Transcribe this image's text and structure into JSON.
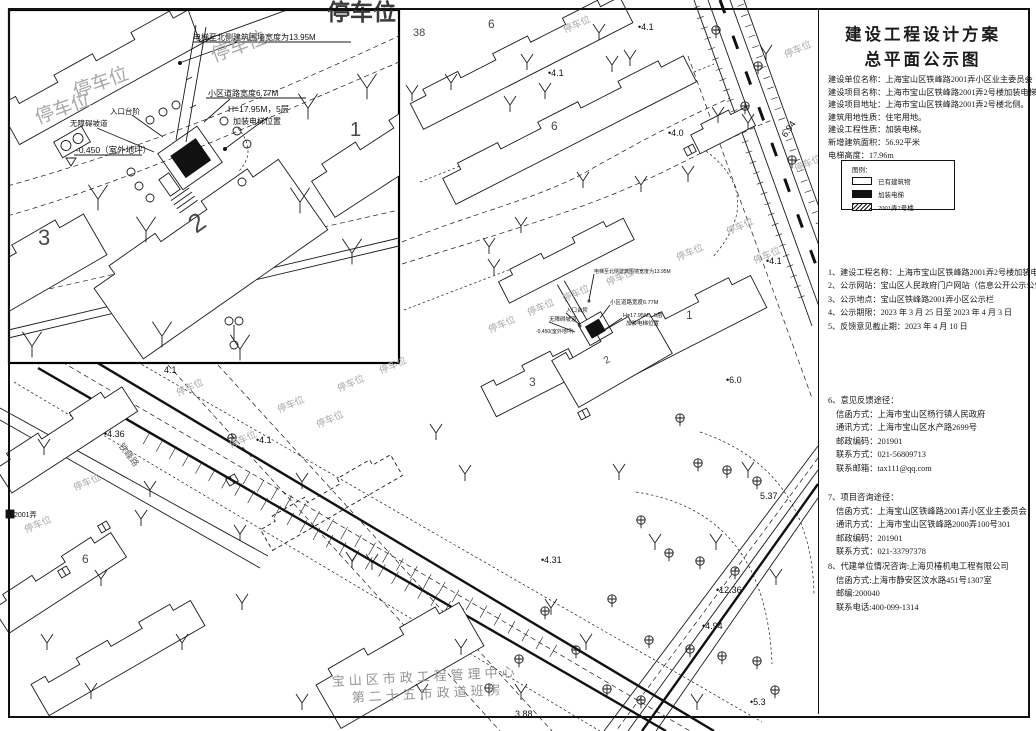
{
  "panel": {
    "title": [
      "建设工程设计方案",
      "总平面公示图"
    ],
    "info": [
      "建设单位名称：上海宝山区铁峰路2001弄小区业主委员会",
      "建设项目名称：上海市宝山区铁峰路2001弄2号楼加装电梯项目。",
      "建设项目地址：上海市宝山区铁峰路2001弄2号楼北侧。",
      "建筑用地性质：住宅用地。",
      "建设工程性质：加装电梯。",
      "新增建筑面积：56.92平米",
      "电梯高度：17.96m"
    ],
    "legend": {
      "title": "图例：",
      "items": [
        {
          "key": "existing",
          "label": "已有建筑物"
        },
        {
          "key": "elevator",
          "label": "加装电梯"
        },
        {
          "key": "hatch",
          "label": "2001弄2号楼"
        }
      ]
    },
    "notices": [
      "1、建设工程名称：上海市宝山区铁峰路2001弄2号楼加装电梯项目",
      "2、公示网站：宝山区人民政府门户网站（信息公开公示公告栏目）",
      "3、公示地点：宝山区铁峰路2001弄小区公示栏",
      "4、公示期限：2023 年 3 月 25 日至 2023 年 4 月 3 日",
      "5、反馈意见截止期：2023 年 4 月 10 日"
    ],
    "sections": [
      {
        "title": "6、意见反馈途径：",
        "lines": [
          "信函方式：上海市宝山区杨行镇人民政府",
          "通讯方式：上海市宝山区水产路2699号",
          "邮政编码：201901",
          "联系方式：021-56809713",
          "联系邮箱：tax111@qq.com"
        ]
      },
      {
        "title": "7、项目咨询途径：",
        "lines": [
          "信函方式：上海宝山区铁峰路2001弄小区业主委员会",
          "通讯方式：上海市宝山区铁峰路2000弄100号301",
          "邮政编码：201901",
          "联系方式：021-33797378"
        ]
      },
      {
        "title": "8、代建单位情况咨询:上海贝椿机电工程有限公司",
        "lines": [
          "信函方式:上海市静安区汶水路451号1307室",
          "邮编:200040",
          "联系电话:400-099-1314"
        ]
      }
    ]
  },
  "plan": {
    "labels": [
      {
        "t": "停车位",
        "x": 565,
        "y": 33,
        "r": -24,
        "s": 9.5,
        "c": "park"
      },
      {
        "t": "停车位",
        "x": 786,
        "y": 58,
        "r": -24,
        "s": 9.5,
        "c": "park"
      },
      {
        "t": "停车位",
        "x": 796,
        "y": 172,
        "r": -24,
        "s": 9.5,
        "c": "park"
      },
      {
        "t": "停车位",
        "x": 728,
        "y": 235,
        "r": -24,
        "s": 9.5,
        "c": "park"
      },
      {
        "t": "停车位",
        "x": 755,
        "y": 264,
        "r": -24,
        "s": 9.5,
        "c": "park"
      },
      {
        "t": "停车位",
        "x": 678,
        "y": 261,
        "r": -24,
        "s": 9.5,
        "c": "park"
      },
      {
        "t": "停车位",
        "x": 608,
        "y": 286,
        "r": -24,
        "s": 9.5,
        "c": "park"
      },
      {
        "t": "停车位",
        "x": 564,
        "y": 302,
        "r": -24,
        "s": 9.5,
        "c": "park"
      },
      {
        "t": "停车位",
        "x": 529,
        "y": 316,
        "r": -24,
        "s": 9.5,
        "c": "park"
      },
      {
        "t": "停车位",
        "x": 490,
        "y": 333,
        "r": -24,
        "s": 9.5,
        "c": "park"
      },
      {
        "t": "停车位",
        "x": 381,
        "y": 374,
        "r": -24,
        "s": 9.5,
        "c": "park"
      },
      {
        "t": "停车位",
        "x": 339,
        "y": 392,
        "r": -24,
        "s": 9.5,
        "c": "park"
      },
      {
        "t": "停车位",
        "x": 279,
        "y": 413,
        "r": -24,
        "s": 9.5,
        "c": "park"
      },
      {
        "t": "停车位",
        "x": 318,
        "y": 428,
        "r": -24,
        "s": 9.5,
        "c": "park"
      },
      {
        "t": "停车位",
        "x": 178,
        "y": 396,
        "r": -24,
        "s": 9.5,
        "c": "park"
      },
      {
        "t": "停车位",
        "x": 231,
        "y": 448,
        "r": -24,
        "s": 9.5,
        "c": "park"
      },
      {
        "t": "停车位",
        "x": 75,
        "y": 491,
        "r": -24,
        "s": 9.5,
        "c": "park"
      },
      {
        "t": "停车位",
        "x": 26,
        "y": 533,
        "r": -24,
        "s": 9.5,
        "c": "park"
      },
      {
        "t": "停车位",
        "x": 214,
        "y": 62,
        "r": -20,
        "s": 19,
        "c": "park"
      },
      {
        "t": "停车位",
        "x": 76,
        "y": 98,
        "r": -20,
        "s": 19,
        "c": "park"
      },
      {
        "t": "停车位",
        "x": 38,
        "y": 124,
        "r": -20,
        "s": 19,
        "c": "park"
      },
      {
        "t": "停车位",
        "x": 327,
        "y": 20,
        "r": 0,
        "s": 23,
        "c": "park-dark"
      },
      {
        "t": "•4.1",
        "x": 638,
        "y": 30,
        "r": 0,
        "s": 9,
        "c": "elev"
      },
      {
        "t": "•4.1",
        "x": 548,
        "y": 76,
        "r": 0,
        "s": 9,
        "c": "elev"
      },
      {
        "t": "•4.0",
        "x": 668,
        "y": 136,
        "r": 0,
        "s": 9,
        "c": "elev"
      },
      {
        "t": "6.94",
        "x": 786,
        "y": 138,
        "r": -55,
        "s": 9,
        "c": "elev"
      },
      {
        "t": "4.1",
        "x": 164,
        "y": 373,
        "r": 0,
        "s": 9,
        "c": "elev"
      },
      {
        "t": "•4.1",
        "x": 766,
        "y": 264,
        "r": 0,
        "s": 9,
        "c": "elev"
      },
      {
        "t": "•6.0",
        "x": 726,
        "y": 383,
        "r": 0,
        "s": 9,
        "c": "elev"
      },
      {
        "t": "•4.1",
        "x": 256,
        "y": 443,
        "r": 0,
        "s": 9,
        "c": "elev"
      },
      {
        "t": "•4.36",
        "x": 104,
        "y": 437,
        "r": 0,
        "s": 9,
        "c": "elev"
      },
      {
        "t": "•4.31",
        "x": 541,
        "y": 563,
        "r": 0,
        "s": 9,
        "c": "elev"
      },
      {
        "t": "5.37",
        "x": 760,
        "y": 499,
        "r": 0,
        "s": 9,
        "c": "elev"
      },
      {
        "t": "•12.36",
        "x": 716,
        "y": 593,
        "r": 0,
        "s": 9,
        "c": "elev"
      },
      {
        "t": "•4.94",
        "x": 702,
        "y": 629,
        "r": 0,
        "s": 9,
        "c": "elev"
      },
      {
        "t": "•5.3",
        "x": 750,
        "y": 705,
        "r": 0,
        "s": 9,
        "c": "elev"
      },
      {
        "t": "3.88",
        "x": 515,
        "y": 717,
        "r": 0,
        "s": 9,
        "c": "elev"
      },
      {
        "t": "2001弄",
        "x": 14,
        "y": 517,
        "r": 0,
        "s": 7,
        "c": "elev"
      },
      {
        "t": "6",
        "x": 488,
        "y": 28,
        "r": 0,
        "s": 12,
        "c": "bnum"
      },
      {
        "t": "38",
        "x": 413,
        "y": 36,
        "r": 0,
        "s": 11,
        "c": "bnum"
      },
      {
        "t": "6",
        "x": 551,
        "y": 130,
        "r": 0,
        "s": 12,
        "c": "bnum"
      },
      {
        "t": "1",
        "x": 686,
        "y": 319,
        "r": 0,
        "s": 12,
        "c": "bnum"
      },
      {
        "t": "3",
        "x": 529,
        "y": 386,
        "r": 0,
        "s": 12,
        "c": "bnum"
      },
      {
        "t": "6",
        "x": 82,
        "y": 563,
        "r": 0,
        "s": 12,
        "c": "bnum"
      },
      {
        "t": "2",
        "x": 606,
        "y": 364,
        "r": -30,
        "s": 10,
        "c": "bnum"
      },
      {
        "t": "3",
        "x": 38,
        "y": 245,
        "r": 0,
        "s": 22,
        "c": "bnum"
      },
      {
        "t": "1",
        "x": 350,
        "y": 136,
        "r": 0,
        "s": 20,
        "c": "bnum"
      },
      {
        "t": "2",
        "x": 196,
        "y": 234,
        "r": -35,
        "s": 26,
        "c": "bnum"
      },
      {
        "t": "电梯至北侧建筑围墙宽度为13.95M",
        "x": 193,
        "y": 40,
        "r": 0,
        "s": 8,
        "c": "anno"
      },
      {
        "t": "小区道路宽度6.77M",
        "x": 208,
        "y": 96,
        "r": 0,
        "s": 8,
        "c": "anno"
      },
      {
        "t": "入口台阶",
        "x": 110,
        "y": 114,
        "r": 0,
        "s": 7.5,
        "c": "anno"
      },
      {
        "t": "无障碍坡道",
        "x": 70,
        "y": 126,
        "r": 0,
        "s": 7.5,
        "c": "anno"
      },
      {
        "t": "H=17.95M，5层",
        "x": 228,
        "y": 112,
        "r": 0,
        "s": 8.5,
        "c": "anno"
      },
      {
        "t": "加装电梯位置",
        "x": 233,
        "y": 124,
        "r": 0,
        "s": 8,
        "c": "anno"
      },
      {
        "t": "-0.450（室外地坪）",
        "x": 76,
        "y": 153,
        "r": 0,
        "s": 8.5,
        "c": "anno"
      },
      {
        "t": "电梯至北侧建筑围墙宽度为13.95M",
        "x": 594,
        "y": 273,
        "r": 0,
        "s": 5,
        "c": "anno"
      },
      {
        "t": "小区道路宽度6.77M",
        "x": 610,
        "y": 304,
        "r": 0,
        "s": 5.5,
        "c": "anno"
      },
      {
        "t": "H=17.95M，5层",
        "x": 623,
        "y": 317,
        "r": 0,
        "s": 5.5,
        "c": "anno"
      },
      {
        "t": "加装电梯位置",
        "x": 626,
        "y": 325,
        "r": 0,
        "s": 5.5,
        "c": "anno"
      },
      {
        "t": "入口台阶",
        "x": 566,
        "y": 312,
        "r": 0,
        "s": 5.5,
        "c": "anno"
      },
      {
        "t": "无障碍坡道",
        "x": 549,
        "y": 321,
        "r": 0,
        "s": 5.5,
        "c": "anno"
      },
      {
        "t": "-0.450(室外地坪)",
        "x": 536,
        "y": 333,
        "r": 0,
        "s": 5,
        "c": "anno"
      },
      {
        "t": "宝山区市政工程管理中心",
        "x": 332,
        "y": 686,
        "r": -3,
        "s": 13,
        "c": "gray-co"
      },
      {
        "t": "第二十五市政道班房",
        "x": 352,
        "y": 702,
        "r": -3,
        "s": 13,
        "c": "gray-co"
      },
      {
        "t": "铁峰路",
        "x": 118,
        "y": 446,
        "r": 52,
        "s": 9,
        "c": "road"
      }
    ]
  }
}
